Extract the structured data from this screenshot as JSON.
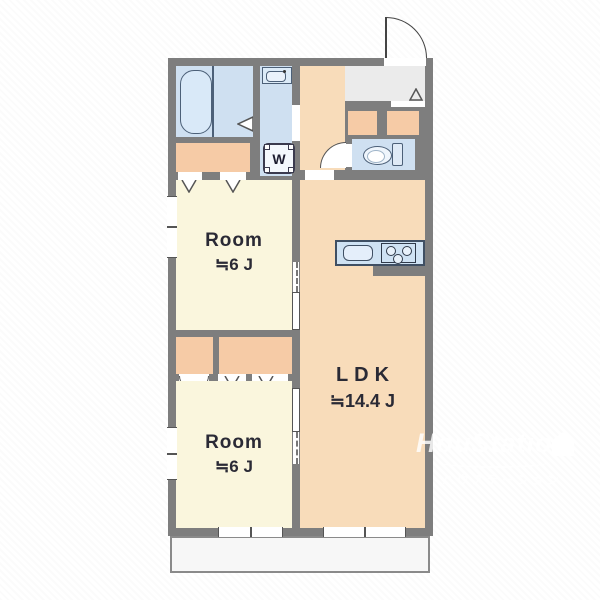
{
  "floor_plan": {
    "room_upper": {
      "name": "Room",
      "area": "≒6 J"
    },
    "room_lower": {
      "name": "Room",
      "area": "≒6 J"
    },
    "ldk": {
      "name": "LDK",
      "area": "≒14.4 J"
    },
    "washer_label": "W"
  },
  "watermark": {
    "brand": "HouStation",
    "subtitle": "ハウステーション"
  },
  "colors": {
    "wall": "#7e7e7e",
    "room_floor": "#faf6dd",
    "ldk_floor": "#f8dcba",
    "closet": "#f6cba6",
    "wet_area": "#cfe0f1",
    "entrance_floor": "#ebebeb",
    "balcony": "#f7f7f7",
    "fixture_line": "#4c6078",
    "label_text": "#2a2a35"
  }
}
